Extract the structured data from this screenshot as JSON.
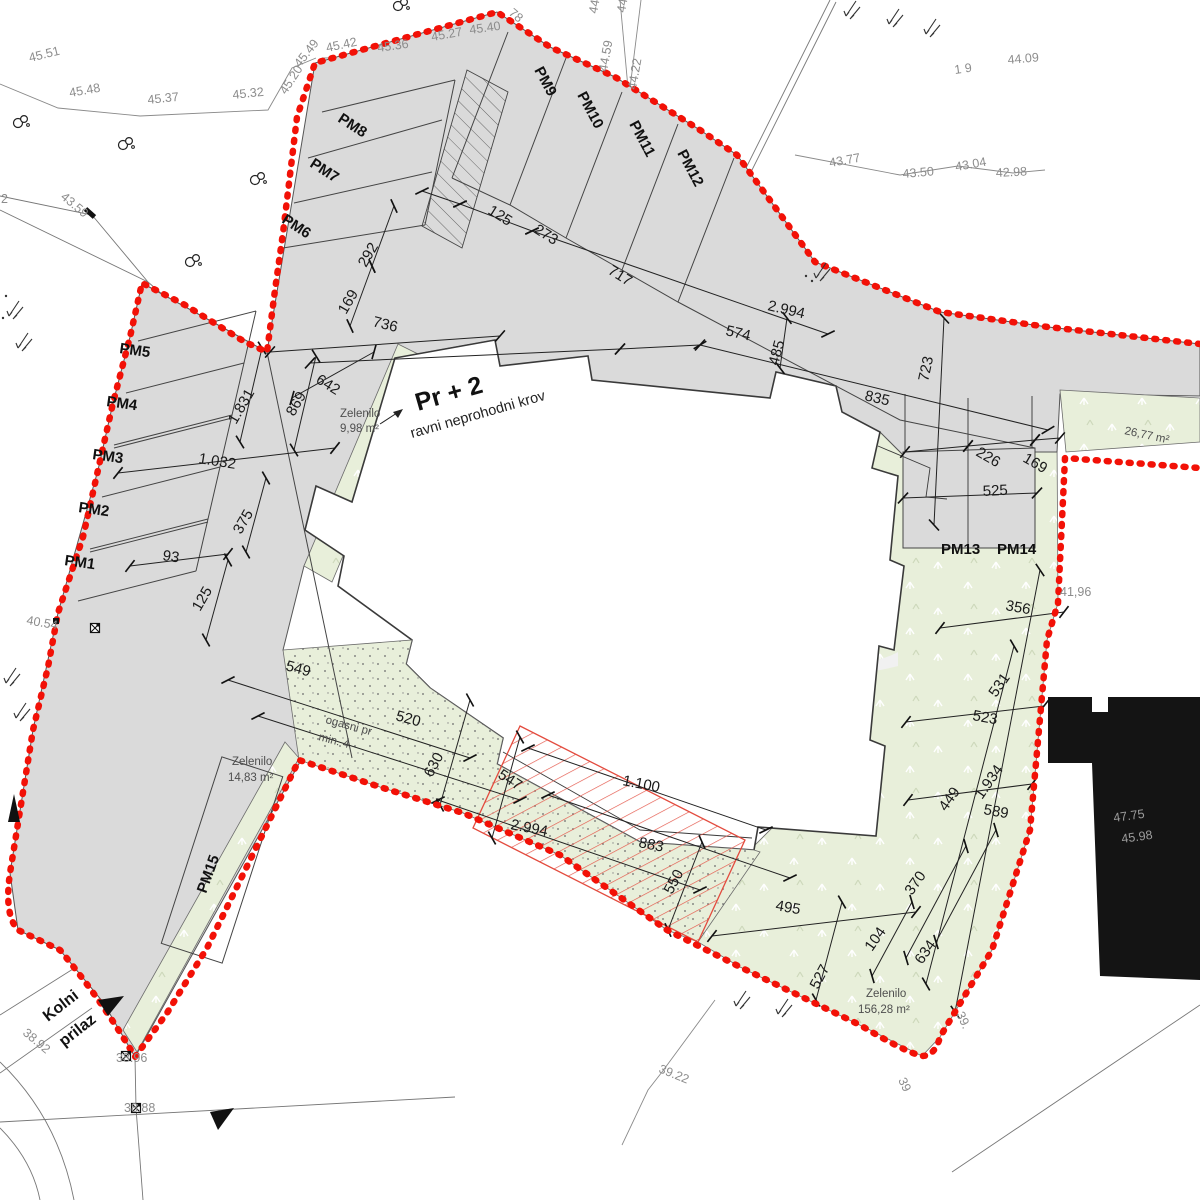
{
  "plan": {
    "type": "architectural site plan",
    "watermark": {
      "name": "REKER",
      "sub": "IMMOBILIEN"
    },
    "colors": {
      "boundary_red": "#f21107",
      "hatch_red": "#e34b3e",
      "parcel_gray": "#dadada",
      "green_area": "#e8efda",
      "neighbor_building_black": "#141414"
    },
    "labels": [
      {
        "t": "45.51",
        "x": 30,
        "y": 62,
        "r": -14,
        "cls": "elev",
        "n": "elev-45-51"
      },
      {
        "t": "45.48",
        "x": 70,
        "y": 97,
        "r": -10,
        "cls": "elev",
        "n": "elev-45-48"
      },
      {
        "t": "45.37",
        "x": 148,
        "y": 104,
        "r": -6,
        "cls": "elev",
        "n": "elev-45-37"
      },
      {
        "t": "45.32",
        "x": 233,
        "y": 99,
        "r": -6,
        "cls": "elev",
        "n": "elev-45-32"
      },
      {
        "t": "45.20",
        "x": 286,
        "y": 95,
        "r": -57,
        "cls": "elev",
        "n": "elev-45-20"
      },
      {
        "t": "45.49",
        "x": 300,
        "y": 68,
        "r": -52,
        "cls": "elev",
        "n": "elev-45-49"
      },
      {
        "t": "45.42",
        "x": 327,
        "y": 52,
        "r": -12,
        "cls": "elev",
        "n": "elev-45-42"
      },
      {
        "t": "45.36",
        "x": 378,
        "y": 52,
        "r": -8,
        "cls": "elev",
        "n": "elev-45-36"
      },
      {
        "t": "45.27",
        "x": 432,
        "y": 41,
        "r": -10,
        "cls": "elev",
        "n": "elev-45-27"
      },
      {
        "t": "45.40",
        "x": 470,
        "y": 34,
        "r": -8,
        "cls": "elev",
        "n": "elev-45-40"
      },
      {
        "t": "78",
        "x": 508,
        "y": 14,
        "r": 40,
        "cls": "elev",
        "n": "elev-78"
      },
      {
        "t": "44.4",
        "x": 597,
        "y": 14,
        "r": -80,
        "cls": "elev",
        "n": "elev-44-4"
      },
      {
        "t": "44.3",
        "x": 625,
        "y": 13,
        "r": -80,
        "cls": "elev",
        "n": "elev-44-3"
      },
      {
        "t": "44.59",
        "x": 607,
        "y": 72,
        "r": -80,
        "cls": "elev",
        "n": "elev-44-59"
      },
      {
        "t": "44.22",
        "x": 636,
        "y": 90,
        "r": -80,
        "cls": "elev",
        "n": "elev-44-22"
      },
      {
        "t": "44.09",
        "x": 1008,
        "y": 64,
        "r": -5,
        "cls": "elev",
        "n": "elev-44-09"
      },
      {
        "t": "1 9",
        "x": 955,
        "y": 74,
        "r": -8,
        "cls": "elev",
        "n": "elev-1-9"
      },
      {
        "t": "43.77",
        "x": 830,
        "y": 167,
        "r": -10,
        "cls": "elev",
        "n": "elev-43-77"
      },
      {
        "t": "43.50",
        "x": 903,
        "y": 178,
        "r": -5,
        "cls": "elev",
        "n": "elev-43-50"
      },
      {
        "t": "43.04",
        "x": 956,
        "y": 171,
        "r": -10,
        "cls": "elev",
        "n": "elev-43-04"
      },
      {
        "t": "42.98",
        "x": 996,
        "y": 177,
        "r": -3,
        "cls": "elev",
        "n": "elev-42-98"
      },
      {
        "t": "43.59",
        "x": 60,
        "y": 198,
        "r": 40,
        "cls": "elev",
        "n": "elev-43-59"
      },
      {
        "t": "2",
        "x": 1,
        "y": 203,
        "r": 0,
        "cls": "elev",
        "n": "elev-2"
      },
      {
        "t": "40.54",
        "x": 26,
        "y": 624,
        "r": 10,
        "cls": "elev",
        "n": "elev-40-54"
      },
      {
        "t": "41,96",
        "x": 1060,
        "y": 596,
        "r": 0,
        "cls": "elev",
        "n": "elev-41-96"
      },
      {
        "t": "38.92",
        "x": 22,
        "y": 1034,
        "r": 40,
        "cls": "elev",
        "n": "elev-38-92"
      },
      {
        "t": "38.96",
        "x": 116,
        "y": 1062,
        "r": 0,
        "cls": "elev",
        "n": "elev-38-96"
      },
      {
        "t": "38.88",
        "x": 124,
        "y": 1112,
        "r": 0,
        "cls": "elev",
        "n": "elev-38-88"
      },
      {
        "t": "39.22",
        "x": 658,
        "y": 1072,
        "r": 22,
        "cls": "elev",
        "n": "elev-39-22"
      },
      {
        "t": "39",
        "x": 898,
        "y": 1080,
        "r": 65,
        "cls": "elev",
        "n": "elev-39"
      },
      {
        "t": "39.",
        "x": 956,
        "y": 1014,
        "r": 65,
        "cls": "elev",
        "n": "elev-39b"
      },
      {
        "t": "47.75",
        "x": 1114,
        "y": 822,
        "r": -8,
        "cls": "onblack",
        "n": "elev-47-75"
      },
      {
        "t": "45.98",
        "x": 1122,
        "y": 843,
        "r": -8,
        "cls": "onblack",
        "n": "elev-45-98"
      },
      {
        "t": "Zelenilo",
        "x": 340,
        "y": 417,
        "r": 0,
        "cls": "area",
        "n": "green-label-1"
      },
      {
        "t": "9,98 m²",
        "x": 340,
        "y": 432,
        "r": 0,
        "cls": "area",
        "n": "green-area-1"
      },
      {
        "t": "Zelenilo",
        "x": 232,
        "y": 765,
        "r": 0,
        "cls": "area",
        "n": "green-label-2"
      },
      {
        "t": "14,83 m²",
        "x": 228,
        "y": 781,
        "r": 0,
        "cls": "area",
        "n": "green-area-2"
      },
      {
        "t": "Zelenilo",
        "x": 866,
        "y": 997,
        "r": 0,
        "cls": "area",
        "n": "green-label-3"
      },
      {
        "t": "156,28 m²",
        "x": 858,
        "y": 1013,
        "r": 0,
        "cls": "area",
        "n": "green-area-3"
      },
      {
        "t": "26,77 m²",
        "x": 1124,
        "y": 434,
        "r": 12,
        "cls": "area",
        "n": "green-area-4"
      },
      {
        "t": "ogasni pr",
        "x": 325,
        "y": 723,
        "r": 15,
        "cls": "area",
        "n": "fire-access-label-1"
      },
      {
        "t": "min. 4",
        "x": 318,
        "y": 740,
        "r": 15,
        "cls": "area",
        "n": "fire-access-label-2"
      },
      {
        "t": "Pr + 2",
        "x": 418,
        "y": 411,
        "r": -16,
        "cls": "ttl1",
        "n": "building-title"
      },
      {
        "t": "ravni neprohodni krov",
        "x": 412,
        "y": 438,
        "r": -16,
        "cls": "ttl2",
        "n": "building-subtitle"
      },
      {
        "t": "Kolni",
        "x": 48,
        "y": 1022,
        "r": -38,
        "cls": "road",
        "n": "road-label-kolni"
      },
      {
        "t": "prilaz",
        "x": 64,
        "y": 1047,
        "r": -38,
        "cls": "road",
        "n": "road-label-prilaz"
      },
      {
        "t": "PM1",
        "x": 64,
        "y": 565,
        "r": 8,
        "cls": "pm",
        "n": "pm1-label"
      },
      {
        "t": "PM2",
        "x": 78,
        "y": 512,
        "r": 8,
        "cls": "pm",
        "n": "pm2-label"
      },
      {
        "t": "PM3",
        "x": 92,
        "y": 459,
        "r": 8,
        "cls": "pm",
        "n": "pm3-label"
      },
      {
        "t": "PM4",
        "x": 106,
        "y": 406,
        "r": 8,
        "cls": "pm",
        "n": "pm4-label"
      },
      {
        "t": "PM5",
        "x": 119,
        "y": 353,
        "r": 8,
        "cls": "pm",
        "n": "pm5-label"
      },
      {
        "t": "PM6",
        "x": 281,
        "y": 222,
        "r": 33,
        "cls": "pm",
        "n": "pm6-label"
      },
      {
        "t": "PM7",
        "x": 309,
        "y": 166,
        "r": 33,
        "cls": "pm",
        "n": "pm7-label"
      },
      {
        "t": "PM8",
        "x": 337,
        "y": 121,
        "r": 33,
        "cls": "pm",
        "n": "pm8-label"
      },
      {
        "t": "PM9",
        "x": 534,
        "y": 70,
        "r": 62,
        "cls": "pm",
        "n": "pm9-label"
      },
      {
        "t": "PM10",
        "x": 577,
        "y": 95,
        "r": 62,
        "cls": "pm",
        "n": "pm10-label"
      },
      {
        "t": "PM11",
        "x": 629,
        "y": 124,
        "r": 62,
        "cls": "pm",
        "n": "pm11-label"
      },
      {
        "t": "PM12",
        "x": 677,
        "y": 153,
        "r": 62,
        "cls": "pm",
        "n": "pm12-label"
      },
      {
        "t": "PM13",
        "x": 941,
        "y": 554,
        "r": 0,
        "cls": "pm",
        "n": "pm13-label"
      },
      {
        "t": "PM14",
        "x": 997,
        "y": 554,
        "r": 0,
        "cls": "pm",
        "n": "pm14-label"
      },
      {
        "t": "PM15",
        "x": 206,
        "y": 894,
        "r": -70,
        "cls": "pm",
        "n": "pm15-label"
      },
      {
        "t": "125",
        "x": 487,
        "y": 213,
        "r": 32,
        "cls": "dim",
        "n": "dim-125-top"
      },
      {
        "t": "273",
        "x": 533,
        "y": 232,
        "r": 32,
        "cls": "dim",
        "n": "dim-273"
      },
      {
        "t": "717",
        "x": 607,
        "y": 273,
        "r": 32,
        "cls": "dim",
        "n": "dim-717"
      },
      {
        "t": "736",
        "x": 372,
        "y": 326,
        "r": 14,
        "cls": "dim",
        "n": "dim-736"
      },
      {
        "t": "642",
        "x": 315,
        "y": 382,
        "r": 32,
        "cls": "dim",
        "n": "dim-642"
      },
      {
        "t": "869",
        "x": 294,
        "y": 417,
        "r": -60,
        "cls": "dim",
        "n": "dim-869"
      },
      {
        "t": "1.831",
        "x": 236,
        "y": 425,
        "r": -60,
        "cls": "dim",
        "n": "dim-1831"
      },
      {
        "t": "292",
        "x": 366,
        "y": 268,
        "r": -60,
        "cls": "dim",
        "n": "dim-292"
      },
      {
        "t": "169",
        "x": 346,
        "y": 315,
        "r": -60,
        "cls": "dim",
        "n": "dim-169-left"
      },
      {
        "t": "1.032",
        "x": 198,
        "y": 463,
        "r": 9,
        "cls": "dim",
        "n": "dim-1032"
      },
      {
        "t": "375",
        "x": 241,
        "y": 535,
        "r": -60,
        "cls": "dim",
        "n": "dim-375"
      },
      {
        "t": "93",
        "x": 162,
        "y": 560,
        "r": 9,
        "cls": "dim",
        "n": "dim-93"
      },
      {
        "t": "125",
        "x": 200,
        "y": 612,
        "r": -60,
        "cls": "dim",
        "n": "dim-125-left"
      },
      {
        "t": "2.994",
        "x": 767,
        "y": 310,
        "r": 13,
        "cls": "dim",
        "n": "dim-2994-top"
      },
      {
        "t": "574",
        "x": 725,
        "y": 335,
        "r": 13,
        "cls": "dim",
        "n": "dim-574"
      },
      {
        "t": "485",
        "x": 778,
        "y": 366,
        "r": -75,
        "cls": "dim",
        "n": "dim-485"
      },
      {
        "t": "723",
        "x": 928,
        "y": 382,
        "r": -78,
        "cls": "dim",
        "n": "dim-723"
      },
      {
        "t": "835",
        "x": 864,
        "y": 400,
        "r": 13,
        "cls": "dim",
        "n": "dim-835"
      },
      {
        "t": "226",
        "x": 975,
        "y": 455,
        "r": 30,
        "cls": "dim",
        "n": "dim-226"
      },
      {
        "t": "169",
        "x": 1022,
        "y": 461,
        "r": 30,
        "cls": "dim",
        "n": "dim-169-right"
      },
      {
        "t": "525",
        "x": 983,
        "y": 496,
        "r": -3,
        "cls": "dim",
        "n": "dim-525"
      },
      {
        "t": "356",
        "x": 1005,
        "y": 610,
        "r": 10,
        "cls": "dim",
        "n": "dim-356"
      },
      {
        "t": "531",
        "x": 996,
        "y": 698,
        "r": -55,
        "cls": "dim",
        "n": "dim-531"
      },
      {
        "t": "523",
        "x": 972,
        "y": 720,
        "r": 10,
        "cls": "dim",
        "n": "dim-523"
      },
      {
        "t": "1.934",
        "x": 982,
        "y": 800,
        "r": -55,
        "cls": "dim",
        "n": "dim-1934"
      },
      {
        "t": "449",
        "x": 946,
        "y": 812,
        "r": -55,
        "cls": "dim",
        "n": "dim-449"
      },
      {
        "t": "589",
        "x": 983,
        "y": 814,
        "r": 10,
        "cls": "dim",
        "n": "dim-589"
      },
      {
        "t": "370",
        "x": 912,
        "y": 896,
        "r": -55,
        "cls": "dim",
        "n": "dim-370"
      },
      {
        "t": "104",
        "x": 872,
        "y": 952,
        "r": -55,
        "cls": "dim",
        "n": "dim-104"
      },
      {
        "t": "634",
        "x": 922,
        "y": 965,
        "r": -55,
        "cls": "dim",
        "n": "dim-634"
      },
      {
        "t": "527",
        "x": 818,
        "y": 990,
        "r": -62,
        "cls": "dim",
        "n": "dim-527"
      },
      {
        "t": "495",
        "x": 775,
        "y": 910,
        "r": 10,
        "cls": "dim",
        "n": "dim-495"
      },
      {
        "t": "550",
        "x": 672,
        "y": 895,
        "r": -62,
        "cls": "dim",
        "n": "dim-550"
      },
      {
        "t": "883",
        "x": 638,
        "y": 847,
        "r": 11,
        "cls": "dim",
        "n": "dim-883"
      },
      {
        "t": "1.100",
        "x": 622,
        "y": 785,
        "r": 11,
        "cls": "dim",
        "n": "dim-1100"
      },
      {
        "t": "547",
        "x": 497,
        "y": 777,
        "r": 33,
        "cls": "dim",
        "n": "dim-547"
      },
      {
        "t": "2.994",
        "x": 510,
        "y": 829,
        "r": 11,
        "cls": "dim",
        "n": "dim-2994-bottom"
      },
      {
        "t": "630",
        "x": 432,
        "y": 778,
        "r": -62,
        "cls": "dim",
        "n": "dim-630"
      },
      {
        "t": "520",
        "x": 395,
        "y": 720,
        "r": 15,
        "cls": "dim",
        "n": "dim-520"
      },
      {
        "t": "549",
        "x": 285,
        "y": 670,
        "r": 15,
        "cls": "dim",
        "n": "dim-549"
      }
    ]
  }
}
